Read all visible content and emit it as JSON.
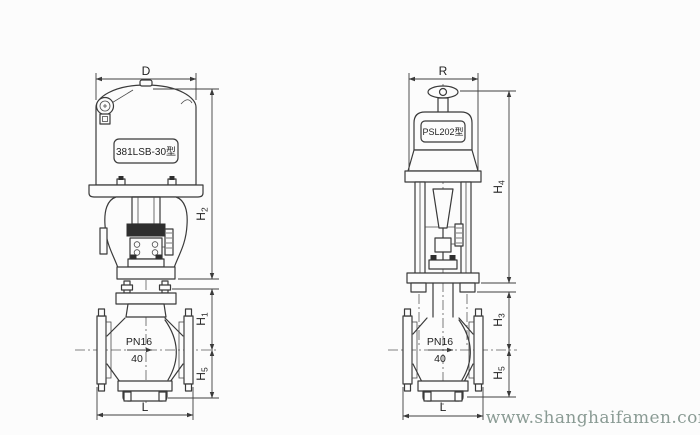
{
  "watermark": {
    "text": "www.shanghaifamen.com"
  },
  "left_valve": {
    "view": "front view, 381LSB electric actuator control valve",
    "actuator_label": "381LSB-30型",
    "pressure_rating": "PN16",
    "nominal_size": "40",
    "dim_width": "D",
    "dim_length": "L",
    "dim_h_upper": {
      "letter": "H",
      "sub": "2"
    },
    "dim_h_mid": {
      "letter": "H",
      "sub": "1"
    },
    "dim_h_lower": {
      "letter": "H",
      "sub": "5"
    }
  },
  "right_valve": {
    "view": "side view, PSL202 electric actuator control valve",
    "actuator_label": "PSL202型",
    "pressure_rating": "PN16",
    "nominal_size": "40",
    "dim_width": "R",
    "dim_length": "L",
    "dim_h_upper": {
      "letter": "H",
      "sub": "4"
    },
    "dim_h_mid": {
      "letter": "H",
      "sub": "3"
    },
    "dim_h_lower": {
      "letter": "H",
      "sub": "5"
    }
  },
  "colors": {
    "line": "#3a3a3a",
    "watermark": "#8a9b94",
    "background": "#fcfcfc"
  }
}
